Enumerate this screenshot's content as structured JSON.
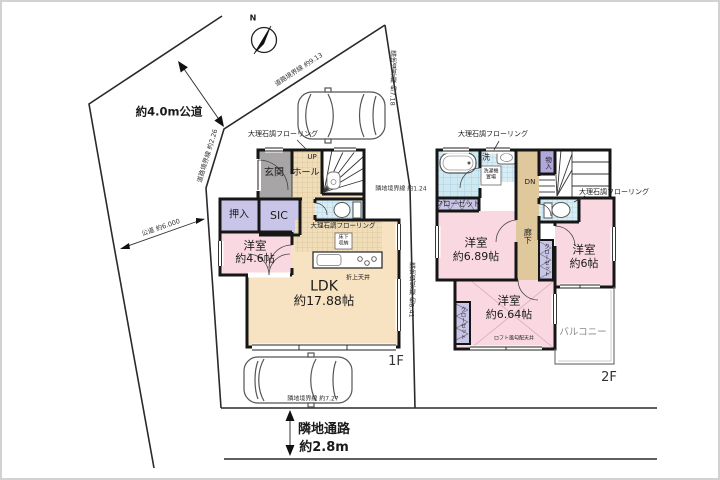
{
  "site": {
    "north": "N",
    "road_label": "約4.0m公道",
    "passage_name": "隣地通路",
    "passage_width": "約2.8m",
    "boundaries": {
      "road_ne": "道路境界線 約9.13",
      "road_nw": "道路境界線 約2.26",
      "road_sw": "公道 約6.000",
      "east_upper": "隣地境界線 約7.18",
      "east_mid": "隣地境界線 約1.24",
      "east_lower": "隣地境界線 約8.41",
      "south": "隣地境界線 約7.27"
    }
  },
  "floor1": {
    "name": "1F",
    "flooring": "大理石調フローリング",
    "kitchen_flooring": "大理石調フローリング",
    "entrance": "玄関",
    "hall": "ホール",
    "stairs_up": "UP",
    "closet": "押入",
    "sic": "SIC",
    "bedroom": {
      "name": "洋室",
      "size": "約4.6帖"
    },
    "ldk": {
      "name": "LDK",
      "size": "約17.88帖"
    },
    "ceiling": "折上天井",
    "floor_storage": "床下収納"
  },
  "floor2": {
    "name": "2F",
    "flooring_top": "大理石調フローリング",
    "flooring_side": "大理石調フローリング",
    "washroom": "洗",
    "laundry": "洗濯機置場",
    "closet_a": "クローゼット",
    "closet_b": "クローゼット",
    "closet_c": "クローゼット",
    "storage": "物入",
    "stairs_down": "DN",
    "corridor": "廊下",
    "bedroom_a": {
      "name": "洋室",
      "size": "約6.89帖"
    },
    "bedroom_b": {
      "name": "洋室",
      "size": "約6帖"
    },
    "bedroom_c": {
      "name": "洋室",
      "size": "約6.64帖"
    },
    "ceiling": "ロフト風勾配天井",
    "balcony": "バルコニー"
  },
  "colors": {
    "wall": "#161616",
    "room_pink": "#f9d8e2",
    "room_beige": "#f7e3c1",
    "room_lavender": "#c9c5e9",
    "storage_purple": "#b2a7db",
    "entrance_gray": "#a8a5a6",
    "water_blue": "#d9edf5",
    "corridor_tan": "#dfc89c"
  }
}
